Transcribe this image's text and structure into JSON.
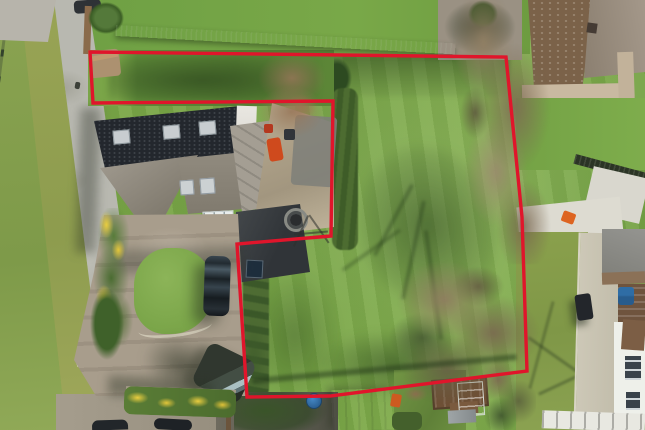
{
  "meta": {
    "description": "Aerial drone photograph of a detached house with driveway and a large adjoining garden plot outlined by a red sale-boundary line; lane on the left, neighbouring houses top-right and bottom-right",
    "image_width_px": 645,
    "image_height_px": 430,
    "visible_text": "none"
  },
  "boundary": {
    "label": "plot-sale-boundary",
    "color": "#e0152b",
    "stroke_width": 3.4,
    "points": [
      [
        90,
        52
      ],
      [
        506,
        57
      ],
      [
        522,
        217
      ],
      [
        527,
        371
      ],
      [
        330,
        396
      ],
      [
        247,
        397
      ],
      [
        237,
        244
      ],
      [
        331,
        236
      ],
      [
        333,
        101
      ],
      [
        93,
        103
      ]
    ]
  },
  "palette": {
    "boundary-red": "#e0152b",
    "field-green": "#7aa747",
    "field-light": "#8db65a",
    "shadow-green": "#2f4e23",
    "verge-green": "#96a355",
    "road-grey": "#b7b7af",
    "gravel-tan": "#a89d8c",
    "roof-black": "#23272d",
    "roof-grey": "#948e82",
    "patio-tan": "#b3a68d",
    "hedge-green": "#47652e",
    "tree-brown": "#8d7b61",
    "fence-dark": "#28321f",
    "nb-roof-brown": "#7b6249",
    "nb-roof-taupe": "#998c7c",
    "concrete-pale": "#ccc7b6",
    "shed-white": "#e9ebe6",
    "greenhouse-teal": "#7fb4a8",
    "car-dark": "#1e262c",
    "van-dark": "#31382f",
    "barrel-blue": "#3579b8",
    "gorse-yellow": "#e5c93c",
    "wall-tan": "#c9b9a1",
    "white-building": "#eef0ea"
  },
  "objects": [
    {
      "name": "lane-road",
      "desc": "patched tarmac lane, left edge"
    },
    {
      "name": "roadside-post-fence",
      "desc": "post and wire fence along verge"
    },
    {
      "name": "metal-fence-top",
      "desc": "dark vertical-bar fence across top of plot"
    },
    {
      "name": "house-black-roof",
      "desc": "long dark slate roof with 3 skylights"
    },
    {
      "name": "house-grey-hip-roof",
      "desc": "grey hipped/gabled roof with 2 skylights"
    },
    {
      "name": "rear-extension-roof",
      "desc": "grey panelled roof beside patio"
    },
    {
      "name": "conservatory-glass-roof",
      "desc": "white glazed panel grid"
    },
    {
      "name": "carport-flat-roof",
      "desc": "light grey ribbed flat roof"
    },
    {
      "name": "garage-dark-roof",
      "desc": "dark grey roof with roof window"
    },
    {
      "name": "paved-patio",
      "desc": "tan flagstone terrace with toys"
    },
    {
      "name": "orange-garden-toy",
      "desc": "orange slide on patio"
    },
    {
      "name": "fire-pit",
      "desc": "round dark fire pit / flue"
    },
    {
      "name": "rotary-clothes-dryer",
      "desc": "thin crossed lines"
    },
    {
      "name": "gravel-driveway",
      "desc": "tan gravel parking area"
    },
    {
      "name": "circular-front-lawn",
      "desc": "round lawn with stone kerb"
    },
    {
      "name": "gorse-bushes",
      "desc": "green bushes with yellow bloom"
    },
    {
      "name": "parked-car-dark",
      "desc": "dark saloon parked nose-on"
    },
    {
      "name": "parked-van-dark",
      "desc": "dark van parked at angle with long shadow"
    },
    {
      "name": "partial-cars-bottom-edge",
      "count": 2
    },
    {
      "name": "paddock-lawn-plot",
      "desc": "large mown lawn inside red boundary"
    },
    {
      "name": "bare-trees-right-boundary",
      "desc": "leafless trees along east boundary"
    },
    {
      "name": "bare-tree-bottom-cluster",
      "desc": "large leafless tree bottom-centre"
    },
    {
      "name": "tree-shadow-on-grass",
      "desc": "branching shadow cast north-west"
    },
    {
      "name": "boundary-hedges",
      "desc": "clipped hedges along notch and west edge"
    },
    {
      "name": "white-garden-shed",
      "desc": "white panel shed, bottom centre"
    },
    {
      "name": "greenhouse",
      "desc": "small teal glazed greenhouse"
    },
    {
      "name": "raised-garden-beds",
      "desc": "brown timber beds"
    },
    {
      "name": "garden-bench",
      "desc": "grey bench"
    },
    {
      "name": "blue-water-butt",
      "desc": "round blue barrel"
    },
    {
      "name": "neighbour-house-top-right",
      "desc": "brown tiled double-pitch roof with chimney"
    },
    {
      "name": "neighbour-retaining-wall",
      "desc": "tan block wall below roof"
    },
    {
      "name": "neighbour-lawn",
      "desc": "green lawns right side"
    },
    {
      "name": "neighbour-paved-driveway",
      "desc": "pale concrete strip running south"
    },
    {
      "name": "neighbour-outbuildings",
      "desc": "grey and brown small roofs, right edge"
    },
    {
      "name": "neighbour-white-house-bottom-right",
      "desc": "white rendered house with dark windows"
    },
    {
      "name": "ride-on-mower",
      "desc": "dark machine on neighbour drive"
    },
    {
      "name": "blue-wheelie-bins",
      "desc": "blue bins at right edge"
    },
    {
      "name": "concrete-pad",
      "desc": "bright pale pad right of boundary"
    },
    {
      "name": "orange-item-on-pad",
      "desc": "small orange object"
    }
  ]
}
